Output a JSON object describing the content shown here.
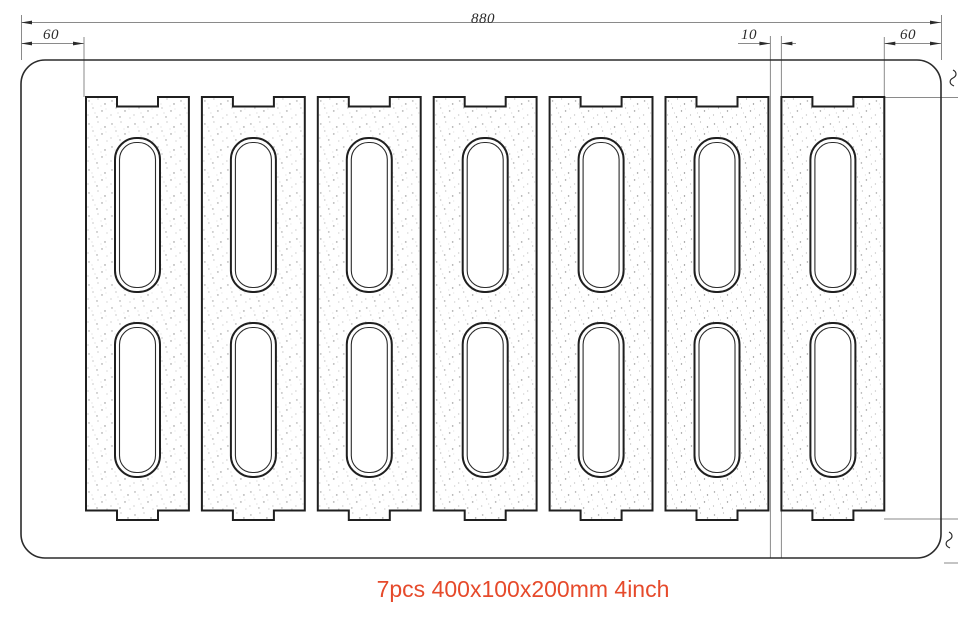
{
  "caption": {
    "text": "7pcs 400x100x200mm 4inch",
    "color": "#e64a2b"
  },
  "drawing": {
    "block_count": 7,
    "dimensions": {
      "total_width": "880",
      "left_margin": "60",
      "block_gap": "10",
      "right_margin": "60"
    },
    "colors": {
      "geometry_line": "#2b2b2b",
      "thin_line": "#8a8a8a",
      "dimension_text": "#2b2b2b"
    }
  }
}
